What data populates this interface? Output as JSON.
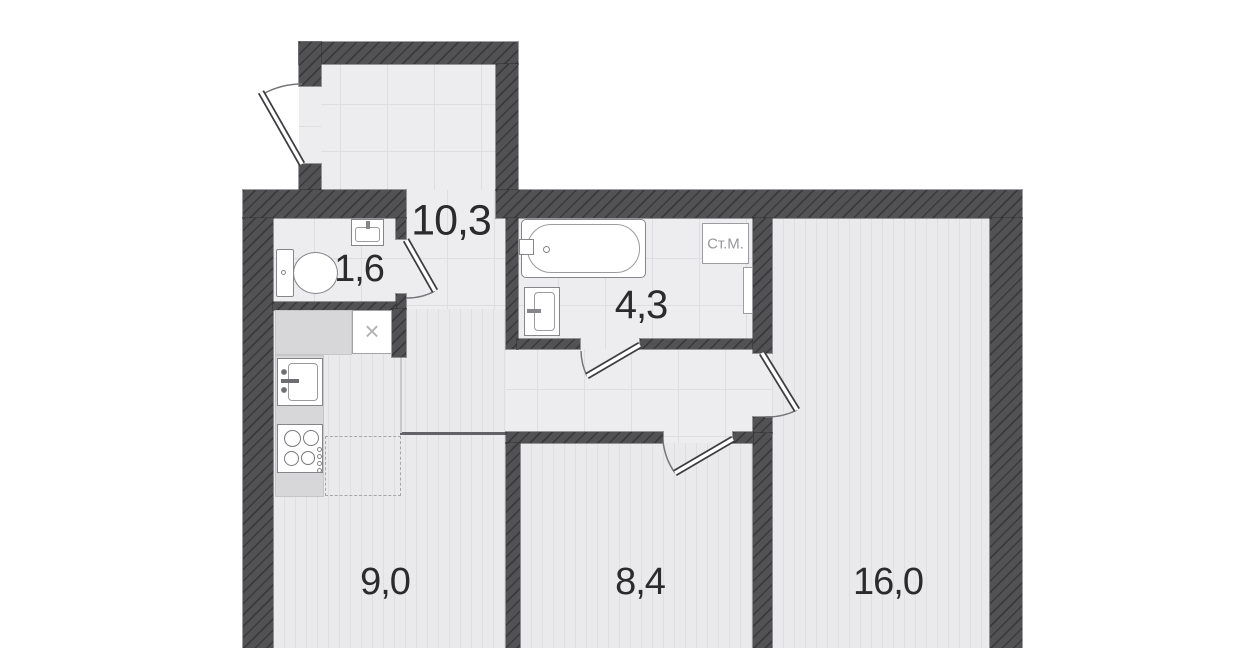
{
  "plan": {
    "title": "apartment-floor-plan",
    "rooms": {
      "hallway": {
        "name": "hallway",
        "area": "10,3"
      },
      "toilet": {
        "name": "toilet",
        "area": "1,6"
      },
      "bathroom": {
        "name": "bathroom",
        "area": "4,3"
      },
      "kitchen": {
        "name": "kitchen",
        "area": "9,0"
      },
      "bedroom": {
        "name": "bedroom",
        "area": "8,4"
      },
      "living_room": {
        "name": "living room",
        "area": "16,0"
      }
    },
    "fixtures": {
      "washing_machine_label": "Ст.М.",
      "shaft_label": "×"
    },
    "colors": {
      "wall": "#525255",
      "tile_floor": "#ededef",
      "tile_line": "#dedee0",
      "wood_floor": "#eaeaec",
      "wood_line": "#dfdfe2",
      "counter": "#d7d7d9",
      "fixture_border": "#85858a",
      "room_label_text": "#2b2b2d",
      "appliance_text": "#97979b"
    }
  }
}
